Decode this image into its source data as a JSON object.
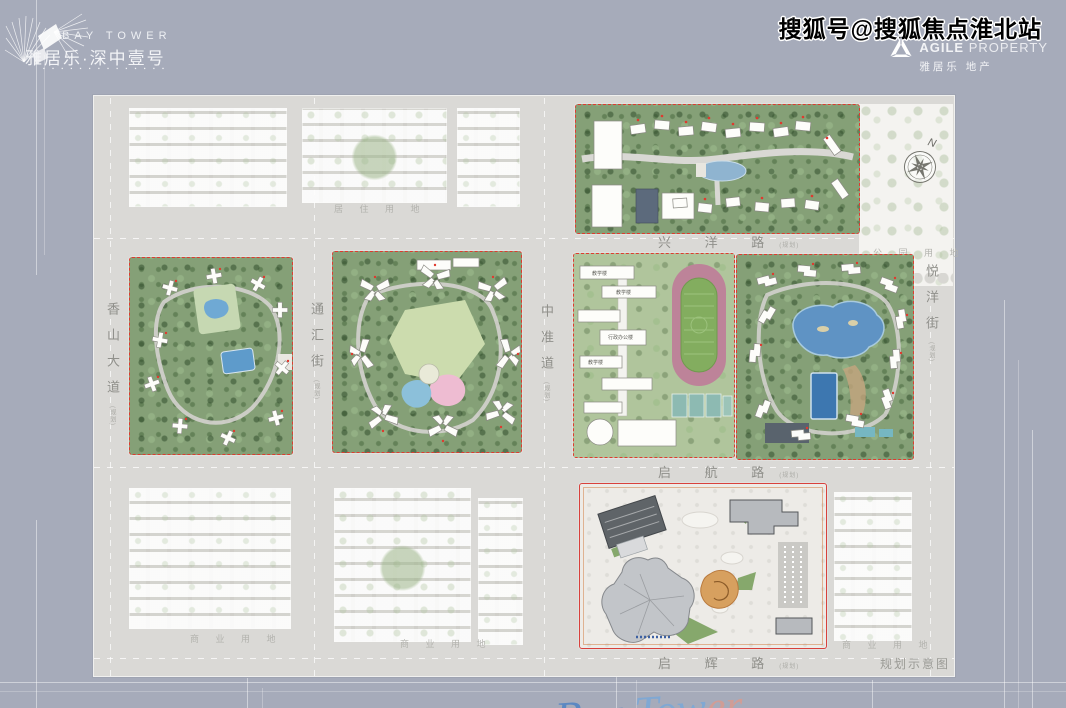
{
  "header": {
    "logo": {
      "en": "BAY TOWER",
      "cn": "雅居乐·深中壹号",
      "dots": "▪ ▪ ▪   ▪ ▪ ▪   ▪ ▪ ▪ ▪ ▪ ▪ ▪ ▪"
    },
    "watermark": "搜狐号@搜狐焦点淮北站",
    "developer": {
      "en_bold": "AGILE",
      "en_light": "PROPERTY",
      "cn": "雅居乐 地产"
    }
  },
  "map": {
    "compass": "N",
    "caption": "规划示意图",
    "roads": {
      "xingyang": "兴 洋 路",
      "qihang": "启 航 路",
      "qihui": "启 辉 路",
      "xiangshan": "香山大道",
      "tonghui": "通汇街",
      "zhonghuai": "中准道",
      "yueyang": "悦洋街",
      "suffix": "(规划)"
    },
    "land_use": {
      "park": "公 园 用 地",
      "residential": "居 住 用 地",
      "commercial": "商 业 用 地"
    },
    "school_labels": {
      "teaching": "教学楼",
      "admin": "行政办公楼"
    },
    "colors": {
      "boundary_red": "#e03a30",
      "water_blue": "#5f93c4",
      "track_pink": "#bd8399",
      "field_green": "#83ad5f",
      "greenery": "#85a077",
      "background": "#a6abba"
    }
  }
}
